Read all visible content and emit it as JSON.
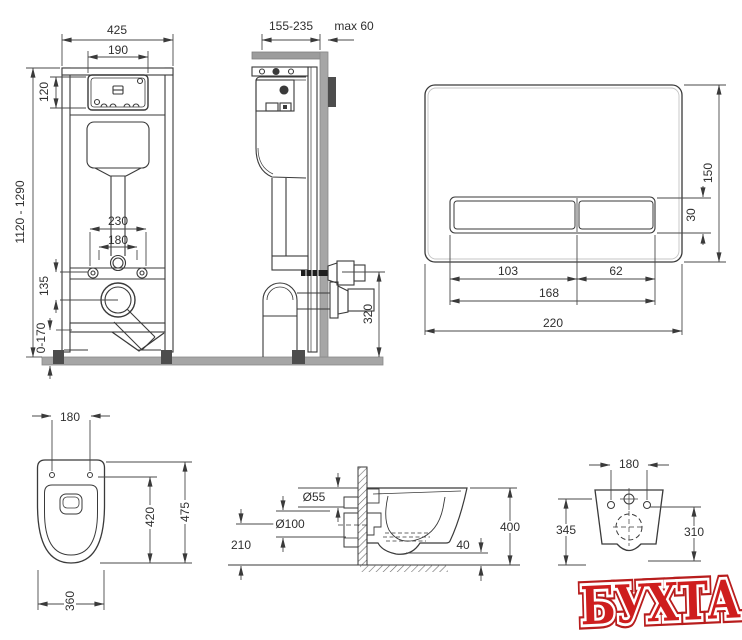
{
  "drawing": {
    "title": "wall-hung toilet installation system technical drawing",
    "colors": {
      "line": "#3a3a3a",
      "wall_gray": "#a6a6a6",
      "block_dark": "#4d4d4d",
      "watermark_red": "#ce1e1e"
    },
    "views": {
      "frame_front": {
        "dims": {
          "width_top": "425",
          "opening_width": "190",
          "panel_height": "120",
          "height_range": "1120 - 1290",
          "bolt_spacing": "230",
          "hole_spacing": "180",
          "outlet_offset": "135",
          "foot_adjust_range": "0-170"
        }
      },
      "frame_side": {
        "dims": {
          "depth_range": "155-235",
          "wall_max": "max 60",
          "outlet_height": "320"
        }
      },
      "flush_plate": {
        "dims": {
          "height": "150",
          "button_height": "30",
          "left_button_width": "103",
          "right_button_width": "62",
          "buttons_width": "168",
          "width": "220"
        }
      },
      "toilet_top": {
        "dims": {
          "hole_spacing": "180",
          "length": "475",
          "inner_length": "420",
          "width": "360"
        }
      },
      "toilet_side": {
        "dims": {
          "inlet_diameter": "Ø55",
          "outlet_diameter": "Ø100",
          "outlet_axis_height": "210",
          "bottom_clearance": "40",
          "total_height": "400"
        }
      },
      "toilet_back": {
        "dims": {
          "hole_spacing": "180",
          "height_left": "345",
          "height_right": "310"
        }
      }
    },
    "watermark": {
      "text": "БУХТА"
    }
  }
}
